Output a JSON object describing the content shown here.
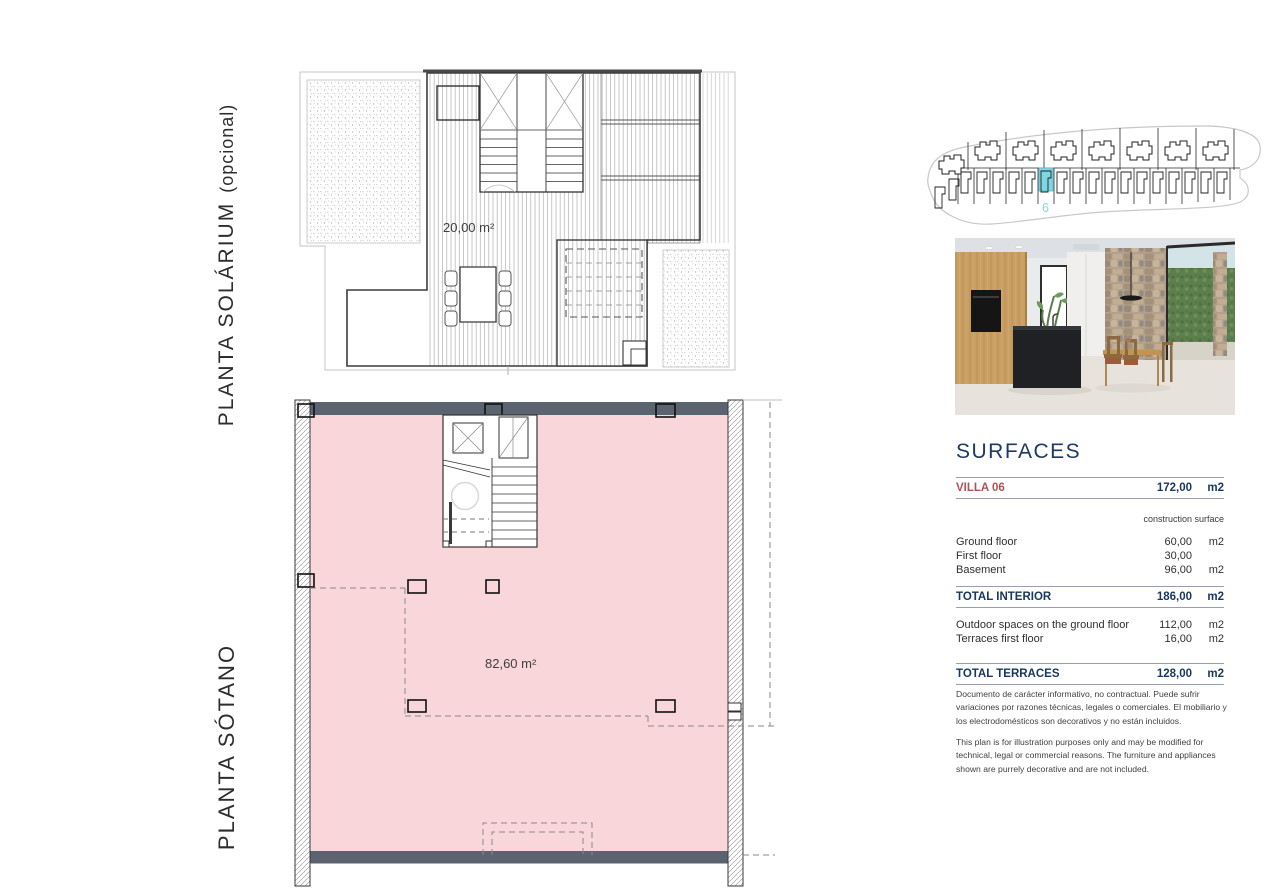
{
  "plans": {
    "solarium": {
      "label": "PLANTA SOLÁRIUM",
      "label_suffix": "(opcional)",
      "area_label": "20,00 m²"
    },
    "sotano": {
      "label": "PLANTA SÓTANO",
      "area_label": "82,60 m²",
      "floor_color": "#f8d6da",
      "slab_color": "#5b6270"
    }
  },
  "siteplan": {
    "unit_number": "6",
    "highlight_color": "#7ed8e4"
  },
  "surfaces": {
    "title": "SURFACES",
    "villa": {
      "label": "VILLA 06",
      "value": "172,00",
      "unit": "m2"
    },
    "column_note": "construction surface",
    "rows": [
      {
        "label": "Ground floor",
        "value": "60,00",
        "unit": "m2"
      },
      {
        "label": "First floor",
        "value": "30,00",
        "unit": ""
      },
      {
        "label": "Basement",
        "value": "96,00",
        "unit": "m2"
      }
    ],
    "total_interior": {
      "label": "TOTAL INTERIOR",
      "value": "186,00",
      "unit": "m2"
    },
    "outdoor_rows": [
      {
        "label": "Outdoor spaces on the ground floor",
        "value": "112,00",
        "unit": "m2"
      },
      {
        "label": "Terraces first floor",
        "value": "16,00",
        "unit": "m2"
      }
    ],
    "total_terraces": {
      "label": "TOTAL TERRACES",
      "value": "128,00",
      "unit": "m2"
    },
    "colors": {
      "heading": "#1f3864",
      "accent": "#ae5357",
      "rule": "#97a0ac"
    }
  },
  "disclaimer": {
    "spanish": "Documento de carácter informativo, no contractual. Puede sufrir variaciones por razones técnicas, legales o comerciales. El mobiliario y los electrodomésticos son decorativos y no están incluidos.",
    "english": "This plan is for illustration purposes only and may be modified for technical, legal or commercial reasons. The furniture and appliances shown are purrely decorative and are not included."
  }
}
